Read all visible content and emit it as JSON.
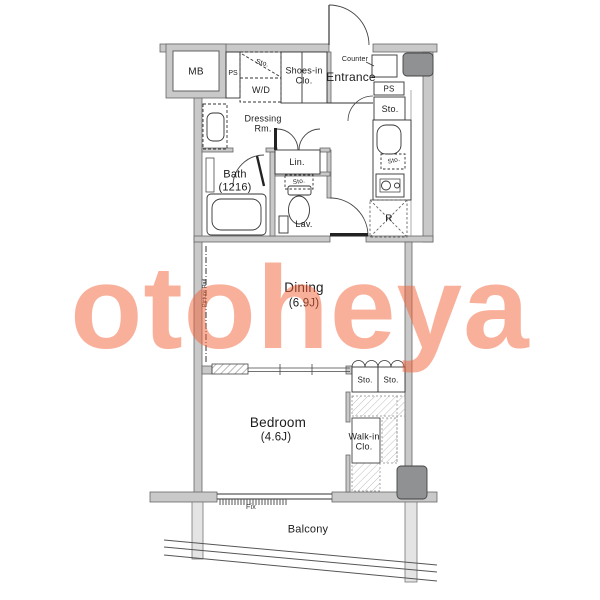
{
  "watermark": {
    "text": "otoheya",
    "color": "rgba(243,97,55,0.5)"
  },
  "colors": {
    "wall_fill": "#c9c9c9",
    "wall_edge": "#666666",
    "line": "#333333",
    "column_fill": "#8f9193"
  },
  "labels": {
    "mb": "MB",
    "ps_left": "PS",
    "sto_wd": "Sto.",
    "wd": "W/D",
    "shoes_clo": "Shoes-in\nClo.",
    "entrance": "Entrance",
    "counter": "Counter",
    "ps_right": "PS",
    "sto_right": "Sto.",
    "dressing_rm": "Dressing\nRm.",
    "lin": "Lin.",
    "bath": "Bath\n(1216)",
    "sto_lav": "Sto.",
    "lav": "Lav.",
    "sto_kitchen": "Sto.",
    "refrigerator": "R",
    "dining_name": "Dining",
    "dining_size": "(6.9J)",
    "picture_rail": "Picture Rail",
    "sto_closet1": "Sto.",
    "sto_closet2": "Sto.",
    "bedroom_name": "Bedroom",
    "bedroom_size": "(4.6J)",
    "walk_in_clo": "Walk-in\nClo.",
    "fix": "Fix",
    "balcony": "Balcony"
  }
}
